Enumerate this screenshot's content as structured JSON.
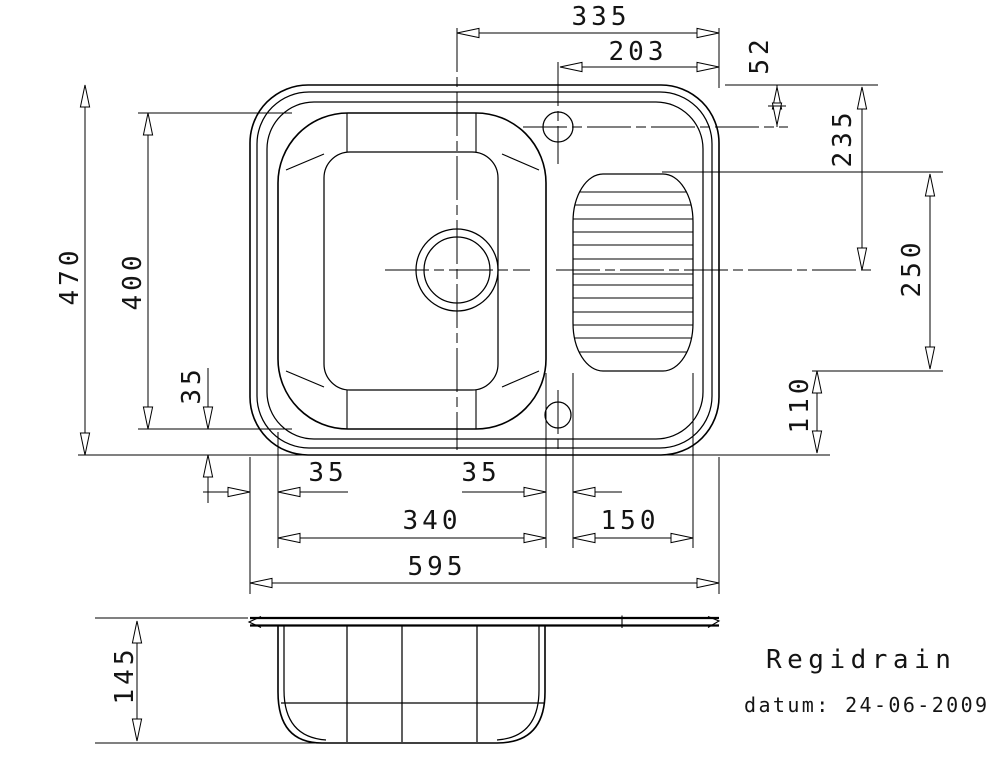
{
  "drawing": {
    "title": "Regidrain",
    "date_line": "datum: 24-06-2009"
  },
  "dimensions": {
    "center_to_right_edge": "335",
    "hole_to_right_edge": "203",
    "hole_offset_top": "52",
    "overall_depth": "470",
    "bowl_depth": "400",
    "bowl_to_bottom_edge": "35",
    "top_edge_to_center": "235",
    "drainer_length": "250",
    "drainer_to_bottom_edge": "110",
    "left_edge_to_bowl": "35",
    "bowl_to_drainer": "35",
    "bowl_width": "340",
    "drainer_width": "150",
    "overall_width": "595",
    "side_depth": "145"
  },
  "colors": {
    "line": "#000000",
    "background": "#ffffff",
    "text": "#141414"
  }
}
